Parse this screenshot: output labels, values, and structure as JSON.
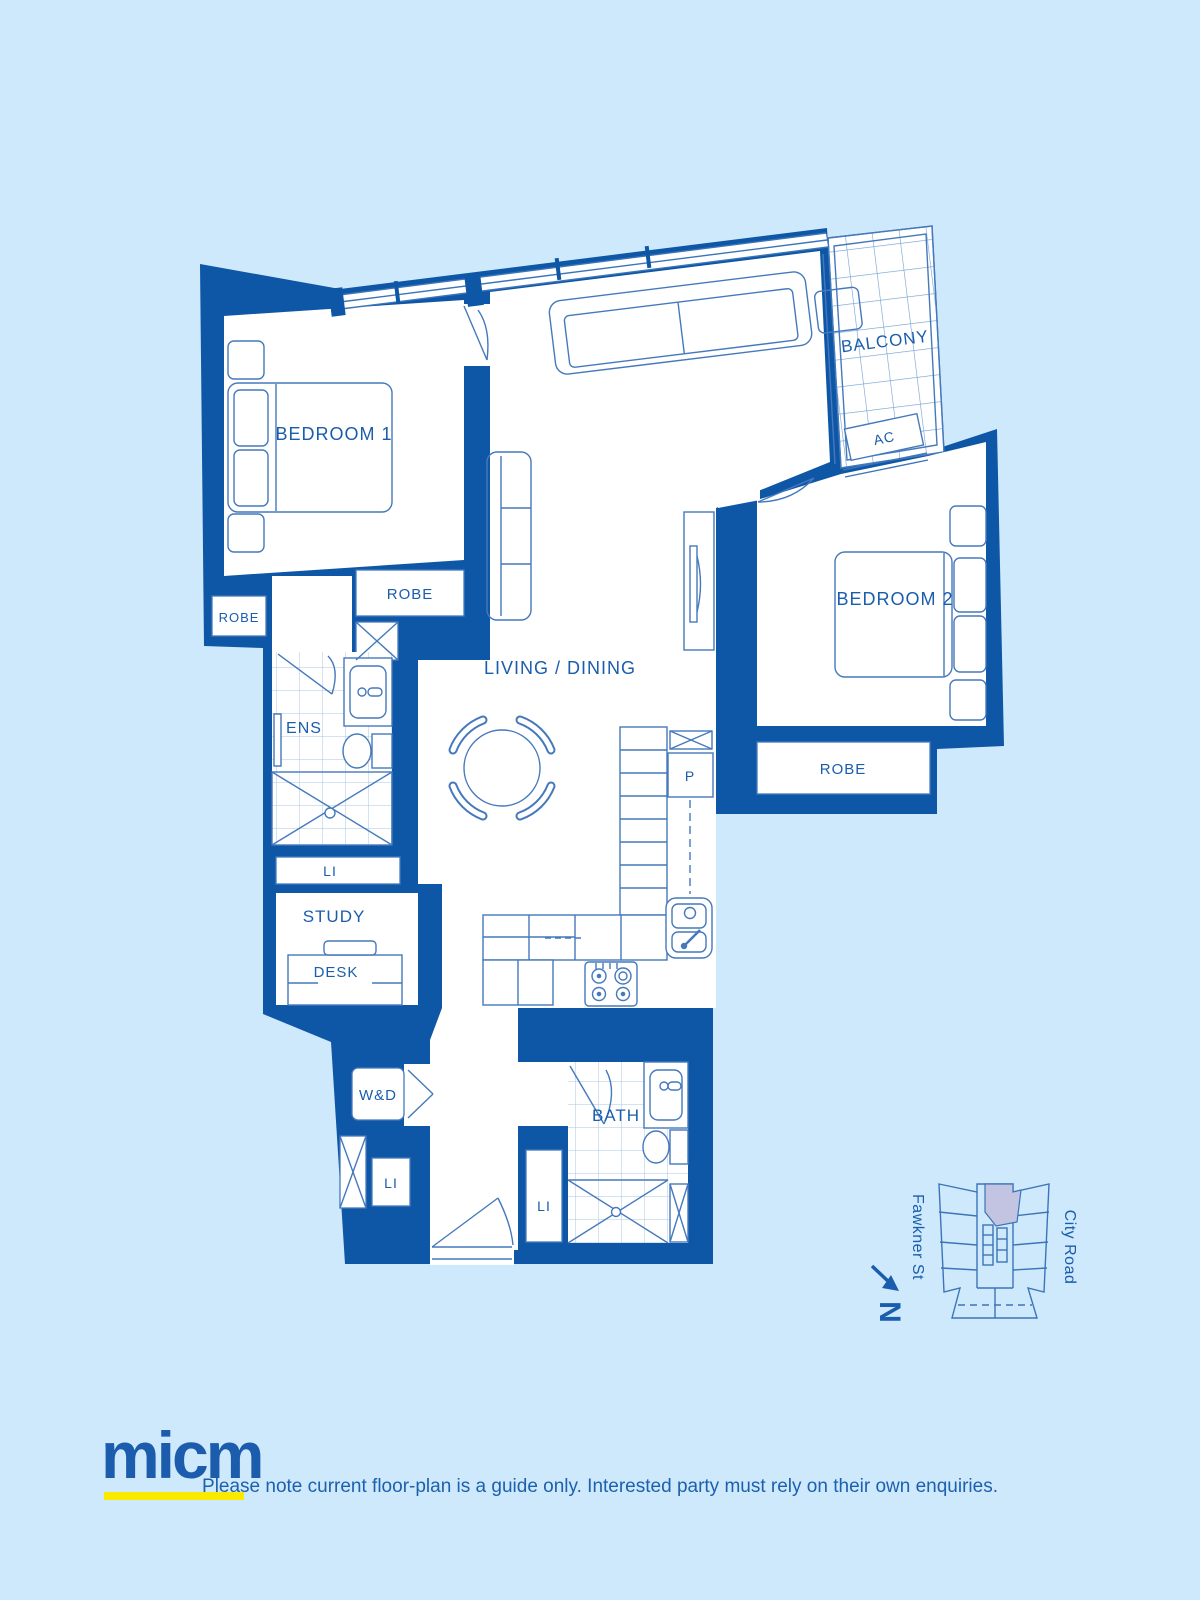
{
  "colors": {
    "background": "#cfe9fc",
    "wall": "#0e57a6",
    "thin_line": "#4579bc",
    "label_text": "#1a5dac",
    "logo_blue": "#1b5cad",
    "logo_underline_yellow": "#f9ea00",
    "keyplan_highlight": "#c2c4e2"
  },
  "floorplan": {
    "labels": {
      "bedroom1": "BEDROOM 1",
      "bedroom2": "BEDROOM 2",
      "living_dining": "LIVING / DINING",
      "balcony": "BALCONY",
      "ac": "AC",
      "ens": "ENS",
      "study": "STUDY",
      "desk": "DESK",
      "bath": "BATH",
      "pantry": "P",
      "washer_dryer": "W&D",
      "robe_bedroom1_left": "ROBE",
      "robe_bedroom1": "ROBE",
      "robe_bedroom2": "ROBE",
      "linen_hall": "LI",
      "linen_entry": "LI",
      "linen_bath": "LI"
    }
  },
  "keyplan": {
    "street_left": "Fawkner St",
    "street_right": "City Road",
    "north_label": "N"
  },
  "footer": {
    "logo_text": "micm",
    "disclaimer": "Please note current floor-plan is a guide only. Interested party must rely on their own enquiries."
  }
}
